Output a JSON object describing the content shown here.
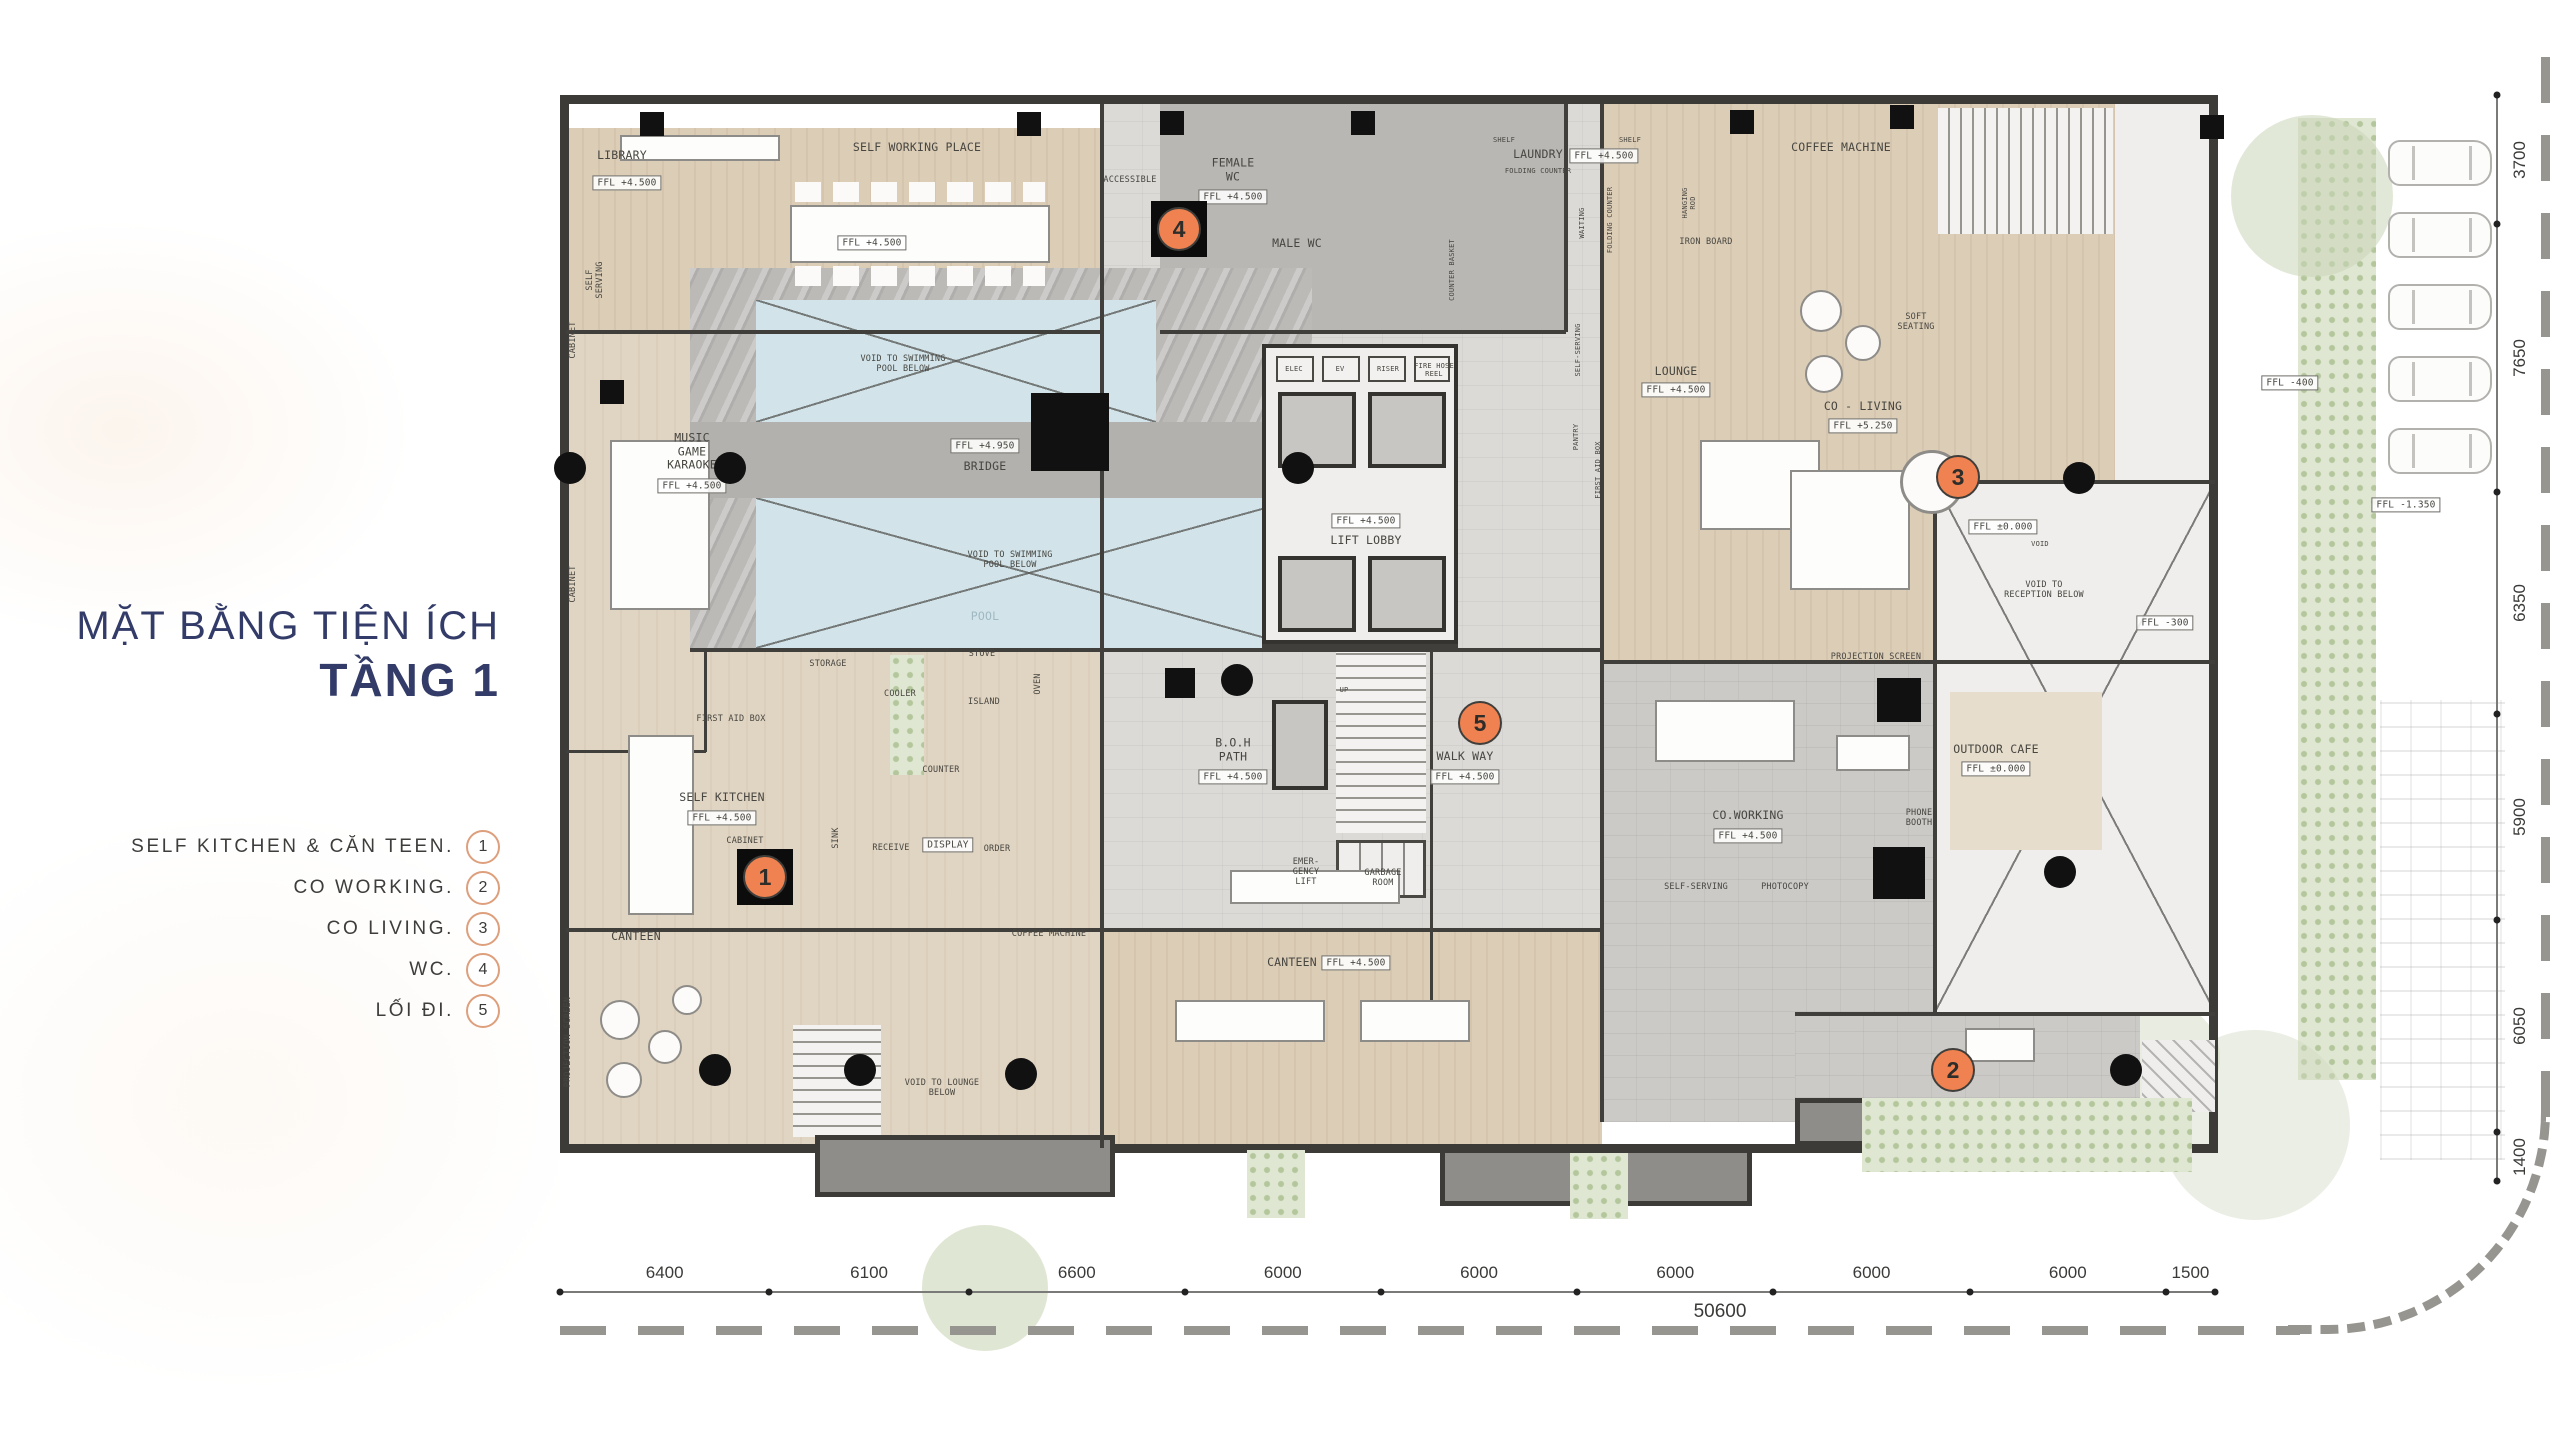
{
  "panel": {
    "title_line1": "MẶT BẰNG TIỆN ÍCH",
    "title_line2": "TẦNG 1",
    "legend": [
      {
        "label": "SELF KITCHEN & CĂN TEEN.",
        "num": "1"
      },
      {
        "label": "CO WORKING.",
        "num": "2"
      },
      {
        "label": "CO LIVING.",
        "num": "3"
      },
      {
        "label": "WC.",
        "num": "4"
      },
      {
        "label": "LỐI ĐI.",
        "num": "5"
      }
    ]
  },
  "plan": {
    "labels": [
      {
        "t": "LIBRARY",
        "x": 622,
        "y": 156
      },
      {
        "t": "FFL  +4.500",
        "x": 627,
        "y": 183,
        "b": true
      },
      {
        "t": "SELF WORKING PLACE",
        "x": 917,
        "y": 148
      },
      {
        "t": "FFL  +4.500",
        "x": 872,
        "y": 243,
        "b": true
      },
      {
        "t": "SELF\nSERVING",
        "x": 595,
        "y": 280,
        "r": true,
        "s": "sm"
      },
      {
        "t": "CABINET",
        "x": 573,
        "y": 340,
        "r": true,
        "s": "sm"
      },
      {
        "t": "MUSIC\nGAME\nKARAOKE",
        "x": 692,
        "y": 452
      },
      {
        "t": "FFL  +4.500",
        "x": 692,
        "y": 486,
        "b": true
      },
      {
        "t": "CABINET",
        "x": 573,
        "y": 584,
        "r": true,
        "s": "sm"
      },
      {
        "t": "FFL  +4.950",
        "x": 985,
        "y": 446,
        "b": true
      },
      {
        "t": "BRIDGE",
        "x": 985,
        "y": 467
      },
      {
        "t": "VOID TO SWIMMING\nPOOL BELOW",
        "x": 903,
        "y": 364,
        "s": "sm"
      },
      {
        "t": "VOID TO SWIMMING\nPOOL BELOW",
        "x": 1010,
        "y": 560,
        "s": "sm"
      },
      {
        "t": "POOL",
        "x": 985,
        "y": 617,
        "c": "#9fb9c2"
      },
      {
        "t": "STORAGE",
        "x": 828,
        "y": 664,
        "s": "sm"
      },
      {
        "t": "COOLER",
        "x": 900,
        "y": 694,
        "s": "sm"
      },
      {
        "t": "STOVE",
        "x": 982,
        "y": 654,
        "s": "sm"
      },
      {
        "t": "ISLAND",
        "x": 984,
        "y": 702,
        "s": "sm"
      },
      {
        "t": "OVEN",
        "x": 1038,
        "y": 684,
        "r": true,
        "s": "sm"
      },
      {
        "t": "FIRST AID BOX",
        "x": 731,
        "y": 719,
        "s": "sm"
      },
      {
        "t": "SELF KITCHEN",
        "x": 722,
        "y": 798
      },
      {
        "t": "FFL  +4.500",
        "x": 722,
        "y": 818,
        "b": true
      },
      {
        "t": "CABINET",
        "x": 745,
        "y": 841,
        "s": "sm"
      },
      {
        "t": "CANTEEN",
        "x": 636,
        "y": 937
      },
      {
        "t": "COUNTER",
        "x": 941,
        "y": 770,
        "s": "sm"
      },
      {
        "t": "SINK",
        "x": 836,
        "y": 838,
        "r": true,
        "s": "sm"
      },
      {
        "t": "RECEIVE",
        "x": 891,
        "y": 848,
        "s": "sm"
      },
      {
        "t": "DISPLAY",
        "x": 948,
        "y": 845,
        "b": true
      },
      {
        "t": "ORDER",
        "x": 997,
        "y": 849,
        "s": "sm"
      },
      {
        "t": "COFFEE MACHINE",
        "x": 1049,
        "y": 934,
        "s": "sm"
      },
      {
        "t": "CANTEEN",
        "x": 1292,
        "y": 963
      },
      {
        "t": "FFL  +4.500",
        "x": 1356,
        "y": 963,
        "b": true
      },
      {
        "t": "PROJECTION SCREEN",
        "x": 568,
        "y": 1042,
        "r": true,
        "s": "sm"
      },
      {
        "t": "VOID TO LOUNGE\nBELOW",
        "x": 942,
        "y": 1088,
        "s": "sm"
      },
      {
        "t": "ACCESSIBLE",
        "x": 1130,
        "y": 180,
        "s": "sm"
      },
      {
        "t": "FEMALE\nWC",
        "x": 1233,
        "y": 170
      },
      {
        "t": "FFL  +4.500",
        "x": 1233,
        "y": 197,
        "b": true
      },
      {
        "t": "MALE WC",
        "x": 1297,
        "y": 244
      },
      {
        "t": "ELEC",
        "x": 1294,
        "y": 369,
        "s": "xs"
      },
      {
        "t": "EV",
        "x": 1340,
        "y": 369,
        "s": "xs"
      },
      {
        "t": "RISER",
        "x": 1388,
        "y": 369,
        "s": "xs"
      },
      {
        "t": "FIRE HOSE\nREEL",
        "x": 1434,
        "y": 370,
        "s": "xs"
      },
      {
        "t": "FFL  +4.500",
        "x": 1366,
        "y": 521,
        "b": true
      },
      {
        "t": "LIFT LOBBY",
        "x": 1366,
        "y": 541
      },
      {
        "t": "UP",
        "x": 1344,
        "y": 690,
        "s": "xs"
      },
      {
        "t": "B.O.H\nPATH",
        "x": 1233,
        "y": 750
      },
      {
        "t": "FFL  +4.500",
        "x": 1233,
        "y": 777,
        "b": true
      },
      {
        "t": "EMER-\nGENCY\nLIFT",
        "x": 1306,
        "y": 872,
        "s": "sm"
      },
      {
        "t": "GARBAGE\nROOM",
        "x": 1383,
        "y": 878,
        "s": "sm"
      },
      {
        "t": "WALK WAY",
        "x": 1465,
        "y": 757
      },
      {
        "t": "FFL  +4.500",
        "x": 1465,
        "y": 777,
        "b": true
      },
      {
        "t": "SHELF",
        "x": 1504,
        "y": 140,
        "s": "xs"
      },
      {
        "t": "SHELF",
        "x": 1630,
        "y": 140,
        "s": "xs"
      },
      {
        "t": "LAUNDRY",
        "x": 1538,
        "y": 155
      },
      {
        "t": "FOLDING COUNTER",
        "x": 1538,
        "y": 171,
        "s": "xs"
      },
      {
        "t": "FFL  +4.500",
        "x": 1604,
        "y": 156,
        "b": true
      },
      {
        "t": "IRON BOARD",
        "x": 1706,
        "y": 242,
        "s": "sm"
      },
      {
        "t": "HANGING\nROD",
        "x": 1689,
        "y": 203,
        "r": true,
        "s": "xs"
      },
      {
        "t": "COUNTER  BASKET",
        "x": 1452,
        "y": 270,
        "r": true,
        "s": "xs"
      },
      {
        "t": "WAITING",
        "x": 1582,
        "y": 223,
        "r": true,
        "s": "xs"
      },
      {
        "t": "FOLDING COUNTER",
        "x": 1610,
        "y": 220,
        "r": true,
        "s": "xs"
      },
      {
        "t": "SELF-SERVING",
        "x": 1578,
        "y": 350,
        "r": true,
        "s": "xs"
      },
      {
        "t": "PANTRY",
        "x": 1576,
        "y": 437,
        "r": true,
        "s": "xs"
      },
      {
        "t": "FIRST AID BOX",
        "x": 1598,
        "y": 470,
        "r": true,
        "s": "xs"
      },
      {
        "t": "COFFEE MACHINE",
        "x": 1841,
        "y": 148
      },
      {
        "t": "LOUNGE",
        "x": 1676,
        "y": 372
      },
      {
        "t": "FFL  +4.500",
        "x": 1676,
        "y": 390,
        "b": true
      },
      {
        "t": "SOFT\nSEATING",
        "x": 1916,
        "y": 322,
        "s": "sm"
      },
      {
        "t": "CO - LIVING",
        "x": 1863,
        "y": 407
      },
      {
        "t": "FFL  +5.250",
        "x": 1863,
        "y": 426,
        "b": true
      },
      {
        "t": "PROJECTION SCREEN",
        "x": 1876,
        "y": 657,
        "s": "sm"
      },
      {
        "t": "FFL  ±0.000",
        "x": 2003,
        "y": 527,
        "b": true
      },
      {
        "t": "VOID",
        "x": 2040,
        "y": 544,
        "s": "xs"
      },
      {
        "t": "VOID TO\nRECEPTION BELOW",
        "x": 2044,
        "y": 590,
        "s": "sm"
      },
      {
        "t": "FFL  -300",
        "x": 2165,
        "y": 623,
        "b": true
      },
      {
        "t": "CO.WORKING",
        "x": 1748,
        "y": 816
      },
      {
        "t": "FFL  +4.500",
        "x": 1748,
        "y": 836,
        "b": true
      },
      {
        "t": "SELF-SERVING",
        "x": 1696,
        "y": 887,
        "s": "sm"
      },
      {
        "t": "PHOTOCOPY",
        "x": 1785,
        "y": 887,
        "s": "sm"
      },
      {
        "t": "PHONE\nBOOTH",
        "x": 1919,
        "y": 818,
        "s": "sm"
      },
      {
        "t": "OUTDOOR CAFE",
        "x": 1996,
        "y": 750
      },
      {
        "t": "FFL  ±0.000",
        "x": 1996,
        "y": 769,
        "b": true
      },
      {
        "t": "FFL  -400",
        "x": 2290,
        "y": 383,
        "b": true
      },
      {
        "t": "FFL  -1.350",
        "x": 2406,
        "y": 505,
        "b": true
      }
    ],
    "markers": [
      {
        "num": "1",
        "x": 765,
        "y": 877,
        "black": true
      },
      {
        "num": "2",
        "x": 1953,
        "y": 1070,
        "black": false
      },
      {
        "num": "3",
        "x": 1958,
        "y": 477,
        "black": false
      },
      {
        "num": "4",
        "x": 1179,
        "y": 229,
        "black": true
      },
      {
        "num": "5",
        "x": 1480,
        "y": 723,
        "black": false
      }
    ],
    "columns": [
      {
        "x": 652,
        "y": 124
      },
      {
        "x": 1029,
        "y": 124
      },
      {
        "x": 1172,
        "y": 123
      },
      {
        "x": 1363,
        "y": 123
      },
      {
        "x": 1742,
        "y": 122
      },
      {
        "x": 1902,
        "y": 117
      },
      {
        "x": 2212,
        "y": 127
      },
      {
        "x": 1070,
        "y": 432,
        "s": 78
      },
      {
        "x": 612,
        "y": 392
      },
      {
        "x": 1180,
        "y": 683,
        "s": 30
      },
      {
        "x": 1899,
        "y": 700,
        "s": 44
      },
      {
        "x": 1899,
        "y": 873,
        "s": 52
      },
      {
        "x": 570,
        "y": 468,
        "ci": true
      },
      {
        "x": 730,
        "y": 468,
        "ci": true
      },
      {
        "x": 1298,
        "y": 468,
        "ci": true
      },
      {
        "x": 1237,
        "y": 680,
        "ci": true
      },
      {
        "x": 2060,
        "y": 872,
        "ci": true
      },
      {
        "x": 2079,
        "y": 478,
        "ci": true
      },
      {
        "x": 715,
        "y": 1070,
        "ci": true
      },
      {
        "x": 860,
        "y": 1070,
        "ci": true
      },
      {
        "x": 1021,
        "y": 1074,
        "ci": true
      },
      {
        "x": 2126,
        "y": 1070,
        "ci": true
      }
    ],
    "dims_bottom": {
      "values": [
        "6400",
        "6100",
        "6600",
        "6000",
        "6000",
        "6000",
        "6000",
        "6000",
        "1500"
      ],
      "total": "50600"
    },
    "dims_right": {
      "values": [
        "3700",
        "7650",
        "6350",
        "5900",
        "6050",
        "1400"
      ]
    }
  },
  "colors": {
    "title_navy": "#333c68",
    "marker_orange": "#ef8250",
    "legend_circle": "#dd9f7c",
    "wall": "#3d3b38",
    "pool_blue": "#d2e4ea"
  }
}
